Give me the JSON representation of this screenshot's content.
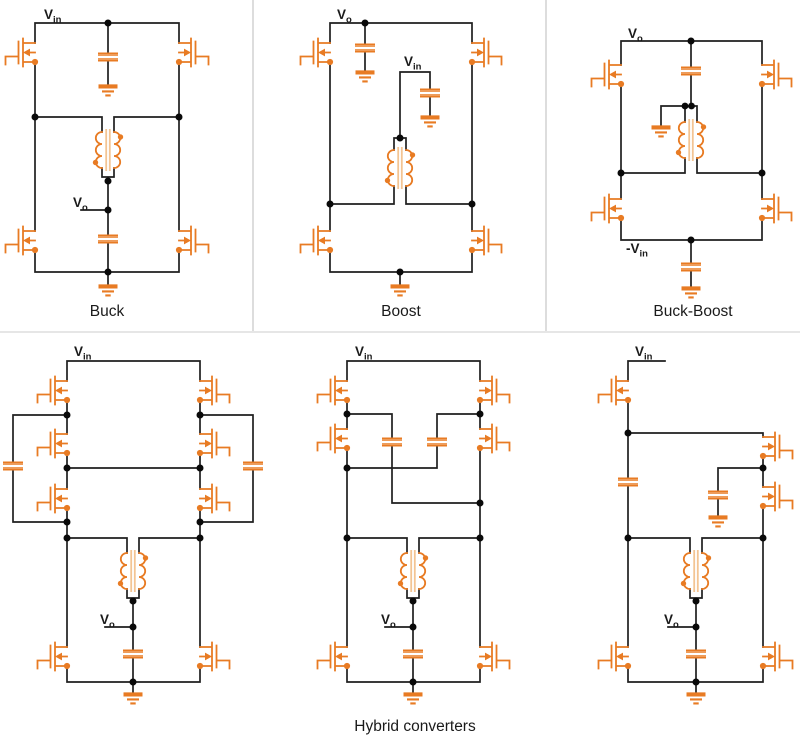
{
  "colors": {
    "component_orange": "#E87B23",
    "inductor_core_tan": "#F3C493",
    "wire_black": "#1F1F1F",
    "junction_dot": "#0A0A0A",
    "divider_gray": "#DDDDDD",
    "background": "#FFFFFF",
    "text": "#1A1A1A"
  },
  "labels": {
    "v": "V",
    "neg_v": "-V",
    "sub_in": "in",
    "sub_o": "o"
  },
  "captions": {
    "buck": "Buck",
    "boost": "Boost",
    "buck_boost": "Buck-Boost",
    "hybrid": "Hybrid converters"
  }
}
